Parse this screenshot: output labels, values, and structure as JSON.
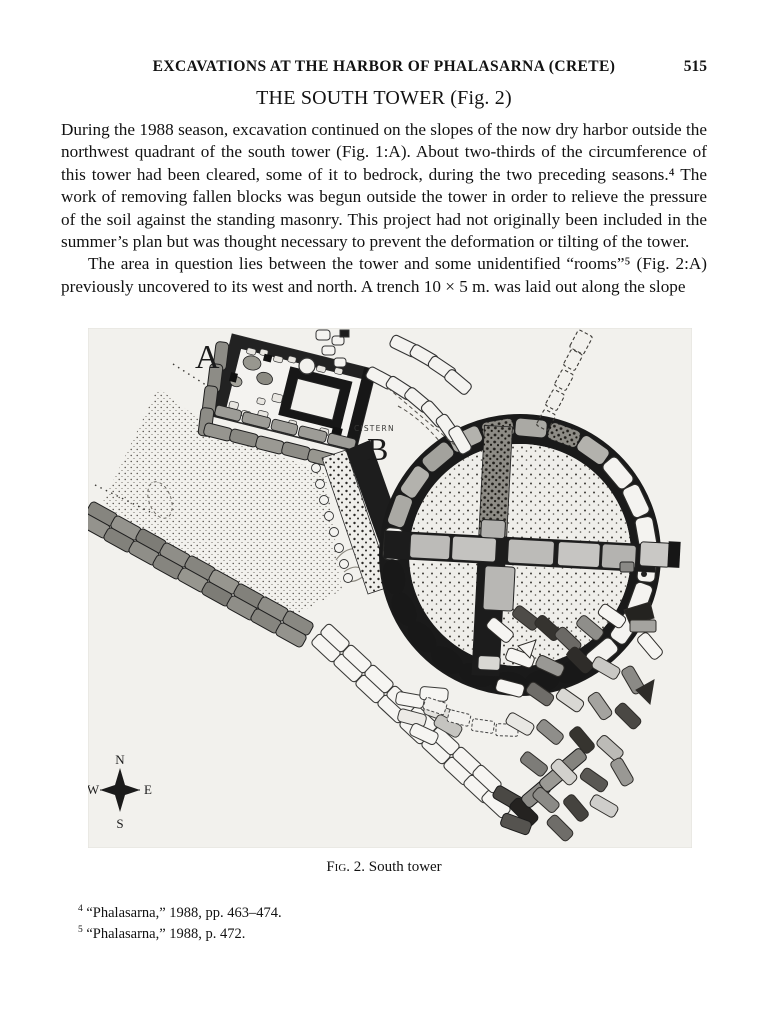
{
  "page": {
    "running_head": "EXCAVATIONS AT THE HARBOR OF PHALASARNA (CRETE)",
    "page_number": "515",
    "section_title": "THE SOUTH TOWER (Fig. 2)",
    "paragraphs": [
      "During the 1988 season, excavation continued on the slopes of the now dry harbor outside the northwest quadrant of the south tower (Fig. 1:A). About two-thirds of the circumference of this tower had been cleared, some of it to bedrock, during the two preceding seasons.⁴ The work of removing fallen blocks was begun outside the tower in order to relieve the pressure of the soil against the standing masonry. This project had not originally been included in the summer’s plan but was thought necessary to prevent the deformation or tilting of the tower.",
      "The area in question lies between the tower and some unidentified “rooms”⁵ (Fig. 2:A) previously uncovered to its west and north. A trench 10 × 5 m. was laid out along the slope"
    ]
  },
  "figure": {
    "labels": {
      "a": "A",
      "b": "B",
      "cistern": "CISTERN"
    },
    "compass": {
      "n": "N",
      "e": "E",
      "s": "S",
      "w": "W"
    },
    "caption_fig": "Fig. 2.",
    "caption_text": "South tower"
  },
  "footnotes": [
    {
      "marker": "4",
      "text": "“Phalasarna,” 1988, pp. 463–474."
    },
    {
      "marker": "5",
      "text": "“Phalasarna,” 1988, p. 472."
    }
  ]
}
